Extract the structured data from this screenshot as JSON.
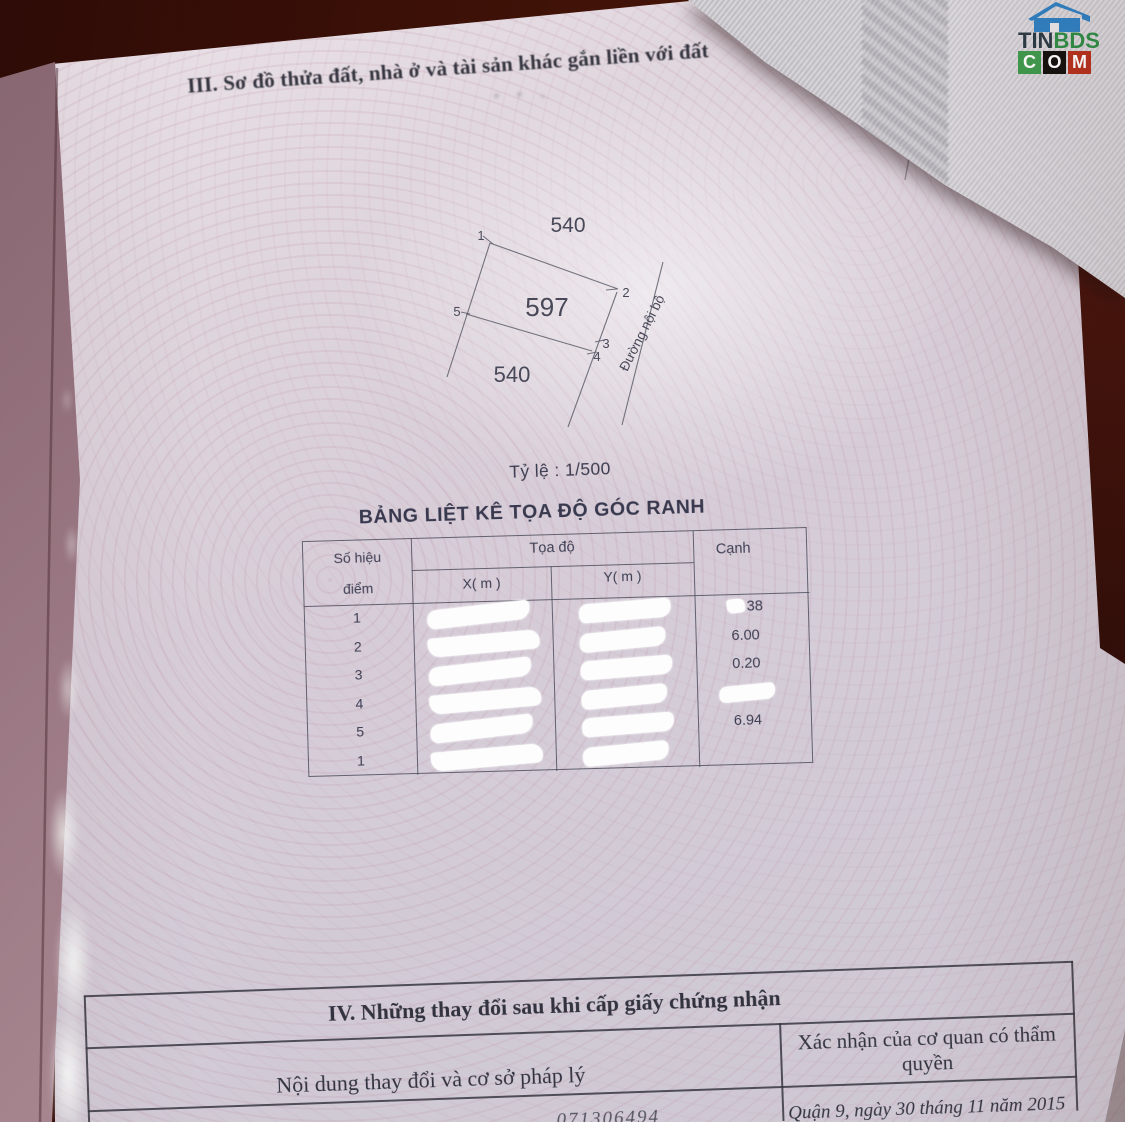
{
  "logo": {
    "tin": "TIN",
    "bds": "BDS",
    "c": "C",
    "o": "O",
    "m": "M"
  },
  "section3": {
    "heading": "III. Sơ đồ thửa đất, nhà ở và tài sản khác gắn liền với đất",
    "diagram": {
      "adjacent_plot_top": "540",
      "plot_number": "597",
      "adjacent_plot_bottom": "540",
      "road_label": "Đường nội bộ",
      "point_1": "1",
      "point_2": "2",
      "point_3": "3",
      "point_4": "4",
      "point_5": "5"
    },
    "scale_label": "Tỷ lệ : 1/500",
    "table": {
      "title": "BẢNG LIỆT KÊ TỌA ĐỘ GÓC RANH",
      "header": {
        "point_line1": "Số hiệu",
        "point_line2": "điểm",
        "coords": "Tọa độ",
        "x": "X( m )",
        "y": "Y( m )",
        "edge": "Cạnh"
      },
      "rows": [
        {
          "point": "1",
          "edge": "38"
        },
        {
          "point": "2",
          "edge": "6.00"
        },
        {
          "point": "3",
          "edge": "0.20"
        },
        {
          "point": "4",
          "edge": ""
        },
        {
          "point": "5",
          "edge": "6.94"
        },
        {
          "point": "1",
          "edge": ""
        }
      ]
    }
  },
  "section4": {
    "heading": "IV. Những thay đổi sau khi cấp giấy chứng nhận",
    "col_left": "Nội dung thay đổi và cơ sở pháp lý",
    "col_right": "Xác nhận của cơ quan có thẩm quyền",
    "footer_date": "Quận 9, ngày 30 tháng 11 năm 2015",
    "footer_fragment": "071306494"
  },
  "colors": {
    "table_background": "#3a0f08",
    "page": "#d7cdd8",
    "spine": "#95737f",
    "logo_blue": "#2f80c2",
    "logo_green": "#2f8d46",
    "logo_red": "#b5321f"
  }
}
